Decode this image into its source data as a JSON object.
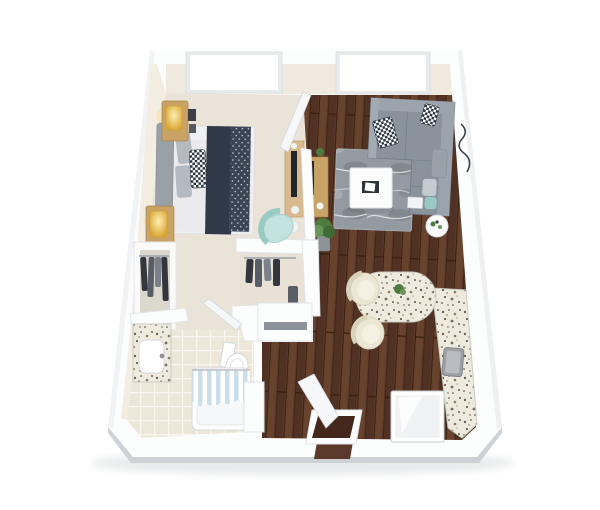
{
  "scene": {
    "description": "3D isometric dollhouse render of a one-bedroom apartment floor plan viewed from above, white walls, no text labels",
    "background": "#ffffff"
  },
  "palette": {
    "wall": "#fcfdfd",
    "wall_edge": "#d7dbde",
    "wall_skirt": "#cdd2d6",
    "wall_face_cream": "#f0e9de",
    "wall_face_left": "#f3ede2",
    "carpet": "#eae3d7",
    "wood_base": "#5c3a2b",
    "wood_light": "#71492f",
    "wood_dark": "#44281d",
    "wood_seam": "#38200f",
    "tile": "#ece7d9",
    "tile_line": "#f9f6ef",
    "granite_base": "#eeeade",
    "rug_base": "#939aa1",
    "rug_light": "#a8aeb4",
    "rug_dark": "#7d848b",
    "rug_vein": "#e6e8ea",
    "sofa": "#8a939c",
    "sofa_light": "#9ba4ad",
    "sofa_dark": "#6f7983",
    "headboard": "#9aa0a7",
    "linen": "#f1f1f3",
    "duvet": "#ebebee",
    "pillow_gray": "#b5bac1",
    "navy": "#2f3947",
    "knit": "#3a4553",
    "knit_dot": "#cfd3da",
    "check": "#2c3542",
    "teal": "#c2e3df",
    "teal_dark": "#98cac4",
    "gold": "#d9a32e",
    "gold_bright": "#ffefb3",
    "wood_furniture": "#c9a266",
    "wood_furniture_dark": "#a8854e",
    "dresser_wood": "#d8ba90",
    "tv": "#22262b",
    "plant": "#4e7c3f",
    "plant_light": "#699556",
    "chrome": "#b9bdc2",
    "chrome_dark": "#8e9296",
    "stool": "#ece6d4",
    "stool_edge": "#d9d2bb",
    "white": "#ffffff",
    "door": "#f6f7f8",
    "appliance_top": "#f0f2f4",
    "clothes_dark": "#33363d",
    "clothes_mid": "#595e66",
    "clothes_light": "#7b818a",
    "curtain_stripe": "#c9dde8",
    "ground_shadow": "#e8eaeb",
    "lamp_glow": "#f7d987"
  },
  "rooms": [
    {
      "name": "bedroom",
      "floor": "carpet",
      "items": [
        "queen-bed",
        "navy-knit-throw",
        "nightstand-1",
        "table-lamp-1",
        "nightstand-2",
        "table-lamp-2",
        "wall-frames",
        "dresser-with-tv",
        "teal-accent-chair",
        "reach-in-closet"
      ]
    },
    {
      "name": "living-room",
      "floor": "hardwood",
      "items": [
        "gray-sectional-sofa",
        "throw-pillows",
        "marble-area-rug",
        "white-coffee-table",
        "round-side-table",
        "media-console-with-tv",
        "floor-plant",
        "wall-art-branch"
      ]
    },
    {
      "name": "kitchen",
      "floor": "hardwood",
      "items": [
        "l-shaped-granite-counter",
        "stainless-sink",
        "bar-stool-1",
        "bar-stool-2",
        "counter-plant",
        "white-appliance"
      ]
    },
    {
      "name": "bathroom",
      "floor": "tile",
      "items": [
        "granite-vanity-with-sink",
        "toilet",
        "bathtub",
        "striped-shower-curtain",
        "linen-cabinet",
        "side-cabinet"
      ]
    },
    {
      "name": "walk-in-closet",
      "floor": "carpet",
      "items": [
        "hanging-clothes"
      ]
    },
    {
      "name": "entry-hall",
      "floor": "hardwood",
      "items": [
        "entry-door",
        "door-threshold"
      ]
    }
  ],
  "openings": {
    "window_count": 2,
    "windows": [
      "bedroom-window-north",
      "living-room-window-north"
    ],
    "doors": [
      "bedroom-door-open",
      "bathroom-door-open",
      "entry-door-open"
    ]
  }
}
